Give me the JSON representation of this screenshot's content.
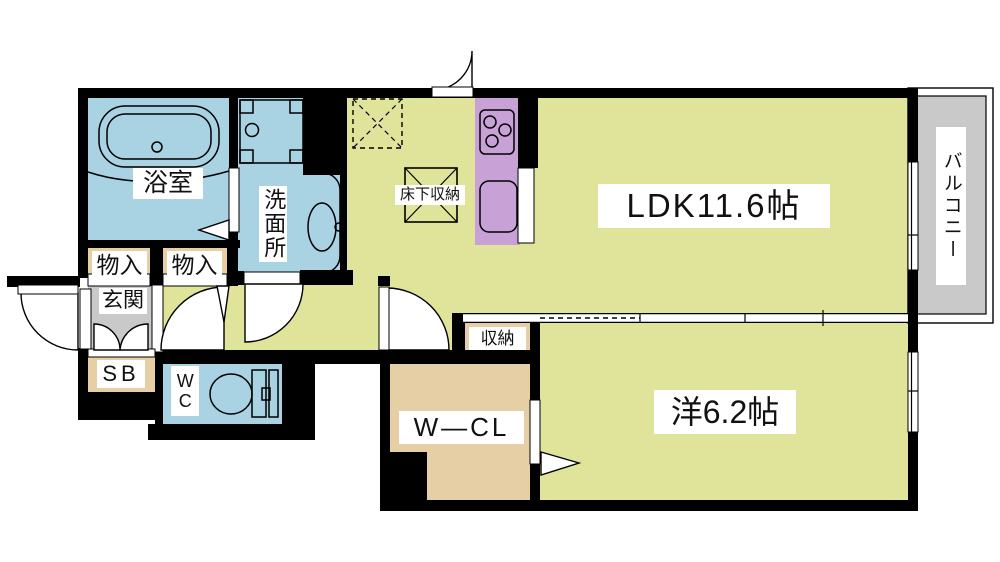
{
  "plan": {
    "type": "japanese-apartment-floor-plan",
    "rooms": {
      "bathroom": "浴室",
      "washroom": "洗面所",
      "storage_1": "物入",
      "storage_2": "物入",
      "entrance": "玄関",
      "shoe_box": "SB",
      "toilet": "WC",
      "underfloor_storage": "床下収納",
      "ldk": "LDK11.6帖",
      "balcony": "バルコニー",
      "closet": "収納",
      "walk_in_closet": "W—CL",
      "western_room": "洋6.2帖"
    },
    "colors": {
      "floor-green": "#dfe49a",
      "water-blue": "#a9d2e3",
      "storage-tan": "#e6cfa4",
      "kitchen-purple": "#c8a2d6",
      "entrance-gray": "#c9c9c9",
      "wall-black": "#000000",
      "label-bg": "#ffffff"
    }
  }
}
